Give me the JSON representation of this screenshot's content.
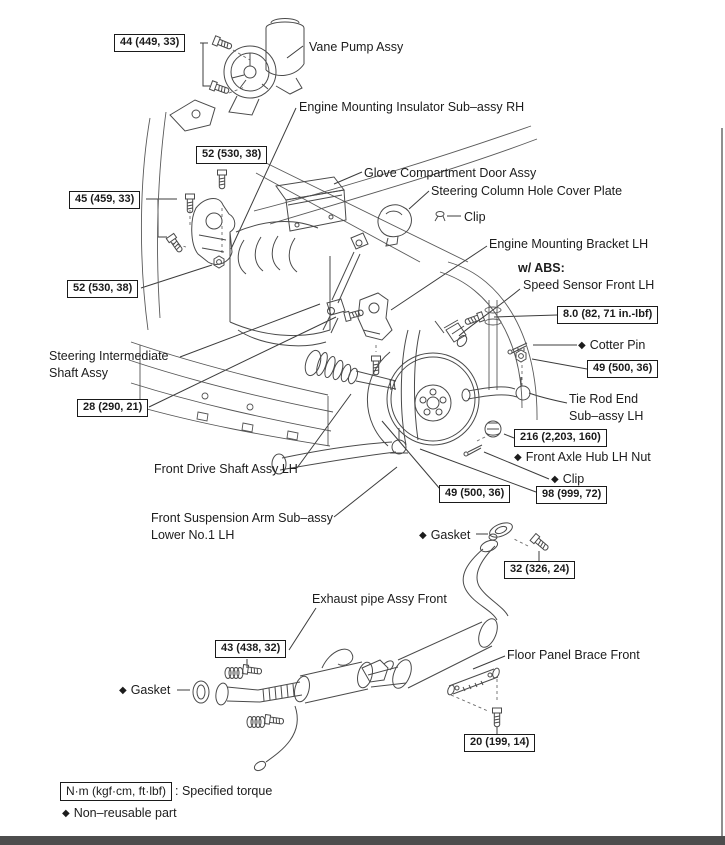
{
  "symbols": {
    "diamond": "◆"
  },
  "labels": {
    "vane_pump": "Vane Pump Assy",
    "engine_mount_insulator_rh": "Engine Mounting Insulator Sub–assy RH",
    "glove_door": "Glove Compartment Door Assy",
    "column_cover": "Steering Column Hole Cover Plate",
    "clip_upper": "Clip",
    "engine_mount_bracket_lh": "Engine Mounting Bracket LH",
    "abs_prefix": "w/ ABS:",
    "speed_sensor": "Speed Sensor Front LH",
    "cotter_pin": "Cotter Pin",
    "tie_rod_line1": "Tie Rod End",
    "tie_rod_line2": "Sub–assy LH",
    "axle_hub_nut": "Front Axle Hub LH Nut",
    "clip_lower": "Clip",
    "steering_shaft_line1": "Steering Intermediate",
    "steering_shaft_line2": "Shaft Assy",
    "drive_shaft": "Front Drive Shaft Assy LH",
    "susp_arm_line1": "Front Suspension Arm Sub–assy",
    "susp_arm_line2": "Lower No.1 LH",
    "gasket_upper": "Gasket",
    "exhaust_pipe": "Exhaust pipe Assy Front",
    "floor_brace": "Floor Panel Brace Front",
    "gasket_lower": "Gasket"
  },
  "torques": {
    "vane_pump": "44 (449, 33)",
    "mount_upper": "52 (530, 38)",
    "mount_side": "45 (459, 33)",
    "mount_lower": "52 (530, 38)",
    "intermediate_shaft": "28 (290, 21)",
    "speed_sensor": "8.0 (82, 71 in.-lbf)",
    "tie_rod": "49 (500, 36)",
    "hub_nut": "216 (2,203, 160)",
    "ball_joint": "98 (999, 72)",
    "susp_arm": "49 (500, 36)",
    "exhaust_upper": "32 (326, 24)",
    "exhaust_front": "43 (438, 32)",
    "floor_brace": "20 (199, 14)"
  },
  "legend": {
    "torque_unit": "N·m (kgf·cm, ft·lbf)",
    "torque_desc": ": Specified torque",
    "non_reusable": "Non–reusable part"
  }
}
